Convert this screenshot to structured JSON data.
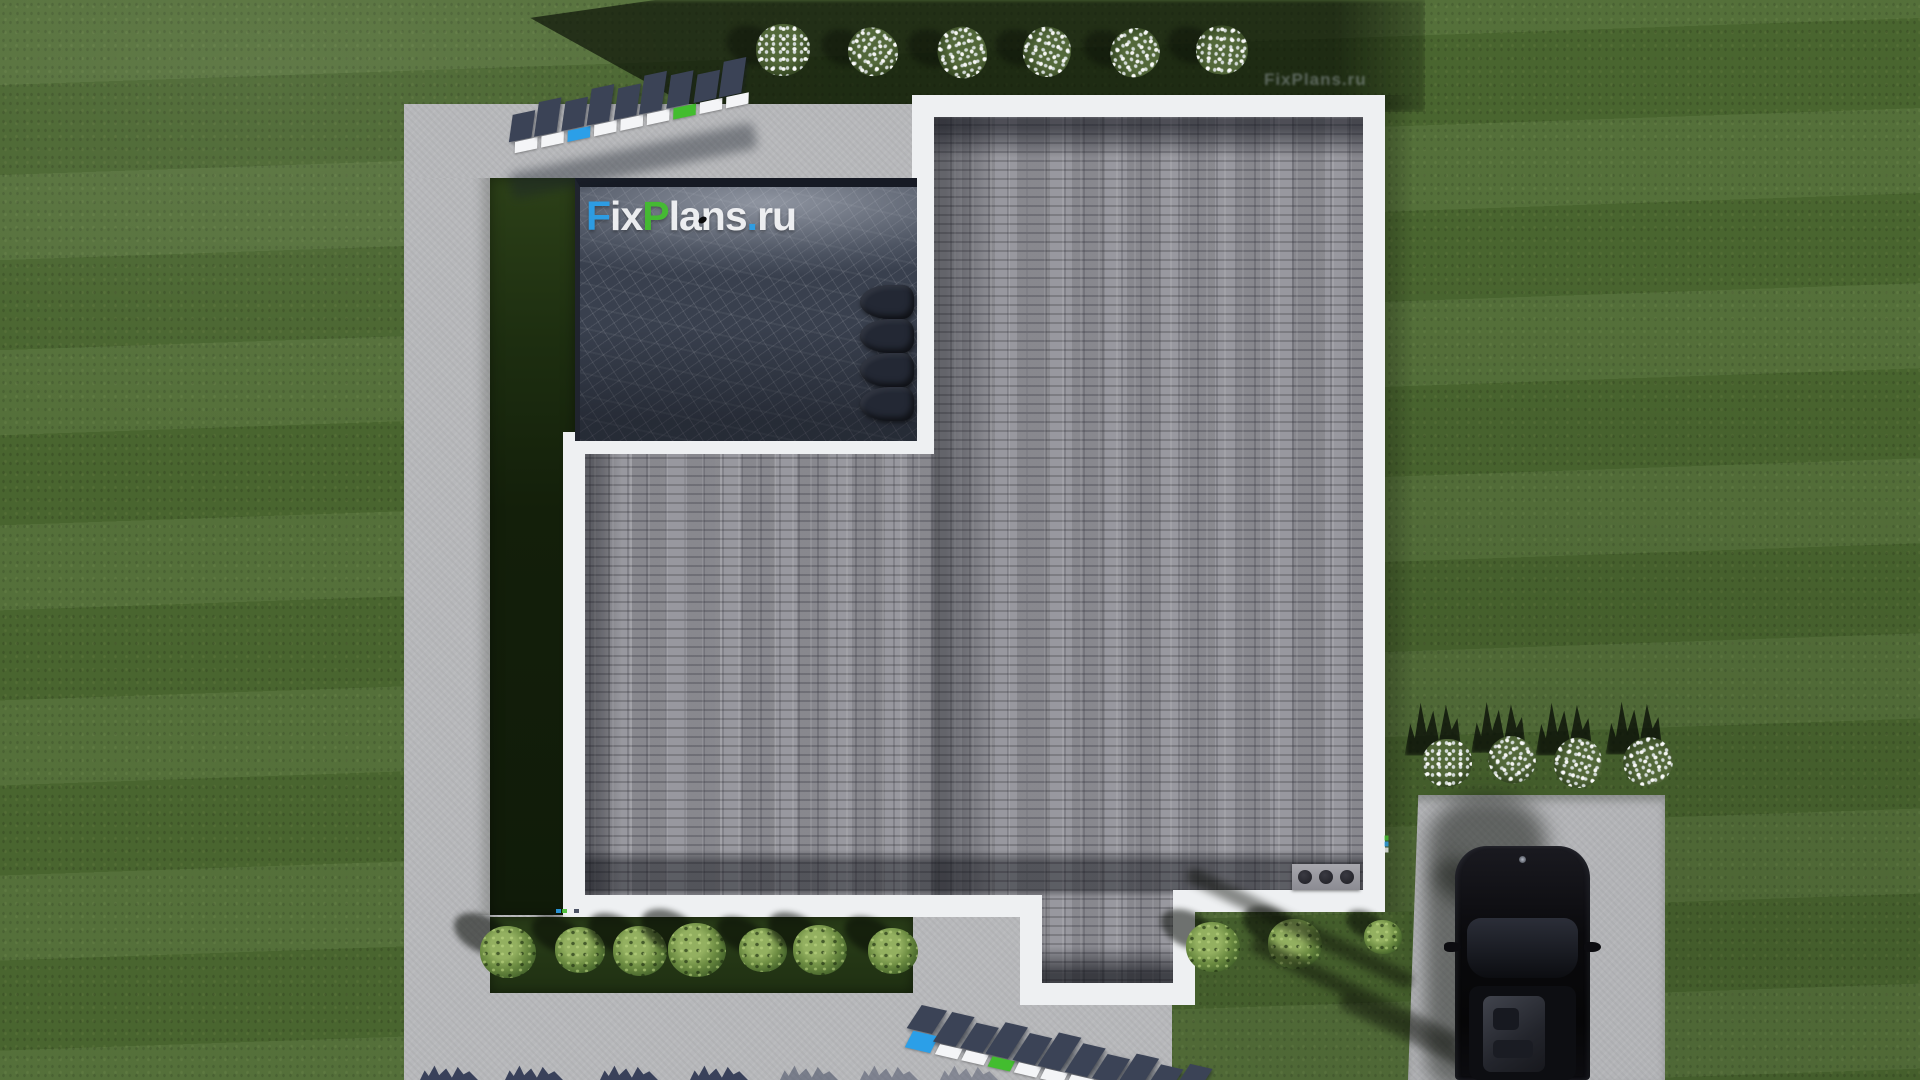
{
  "brand": {
    "full": "FixPlans.ru",
    "f": "F",
    "ix": "ix",
    "p": "P",
    "lans": "lans",
    "dot": ".",
    "ru": "ru"
  },
  "palette": {
    "brand_blue": "#2b9fe8",
    "brand_green": "#43bd2f",
    "face_white": "#f4f5f7",
    "lawn_green": "#4d6a31",
    "shadow_green": "#1f2f15",
    "concrete_gray": "#b7b8bb",
    "roof_shingle_gray": "#93939a",
    "terrace_slate": "#39404e",
    "letter_slab_navy": "#3b4356",
    "house_trim_white": "#eef0f2",
    "car_black": "#0b0b0e"
  },
  "watermarks": {
    "logo_center": {
      "text": "FixPlans.ru"
    },
    "faint_top_right": {
      "text": "FixPlans.ru"
    },
    "top_extruded": {
      "text": "FixPlans.ru",
      "mirrored": true,
      "face_colors": [
        "white",
        "white",
        "blue",
        "white",
        "white",
        "white",
        "green",
        "white",
        "white"
      ]
    },
    "bottom_extruded": {
      "text": "FixPlans.ru",
      "face_colors": [
        "blue",
        "white",
        "white",
        "green",
        "white",
        "white",
        "white",
        "white",
        "blue",
        "white",
        "white"
      ]
    }
  }
}
